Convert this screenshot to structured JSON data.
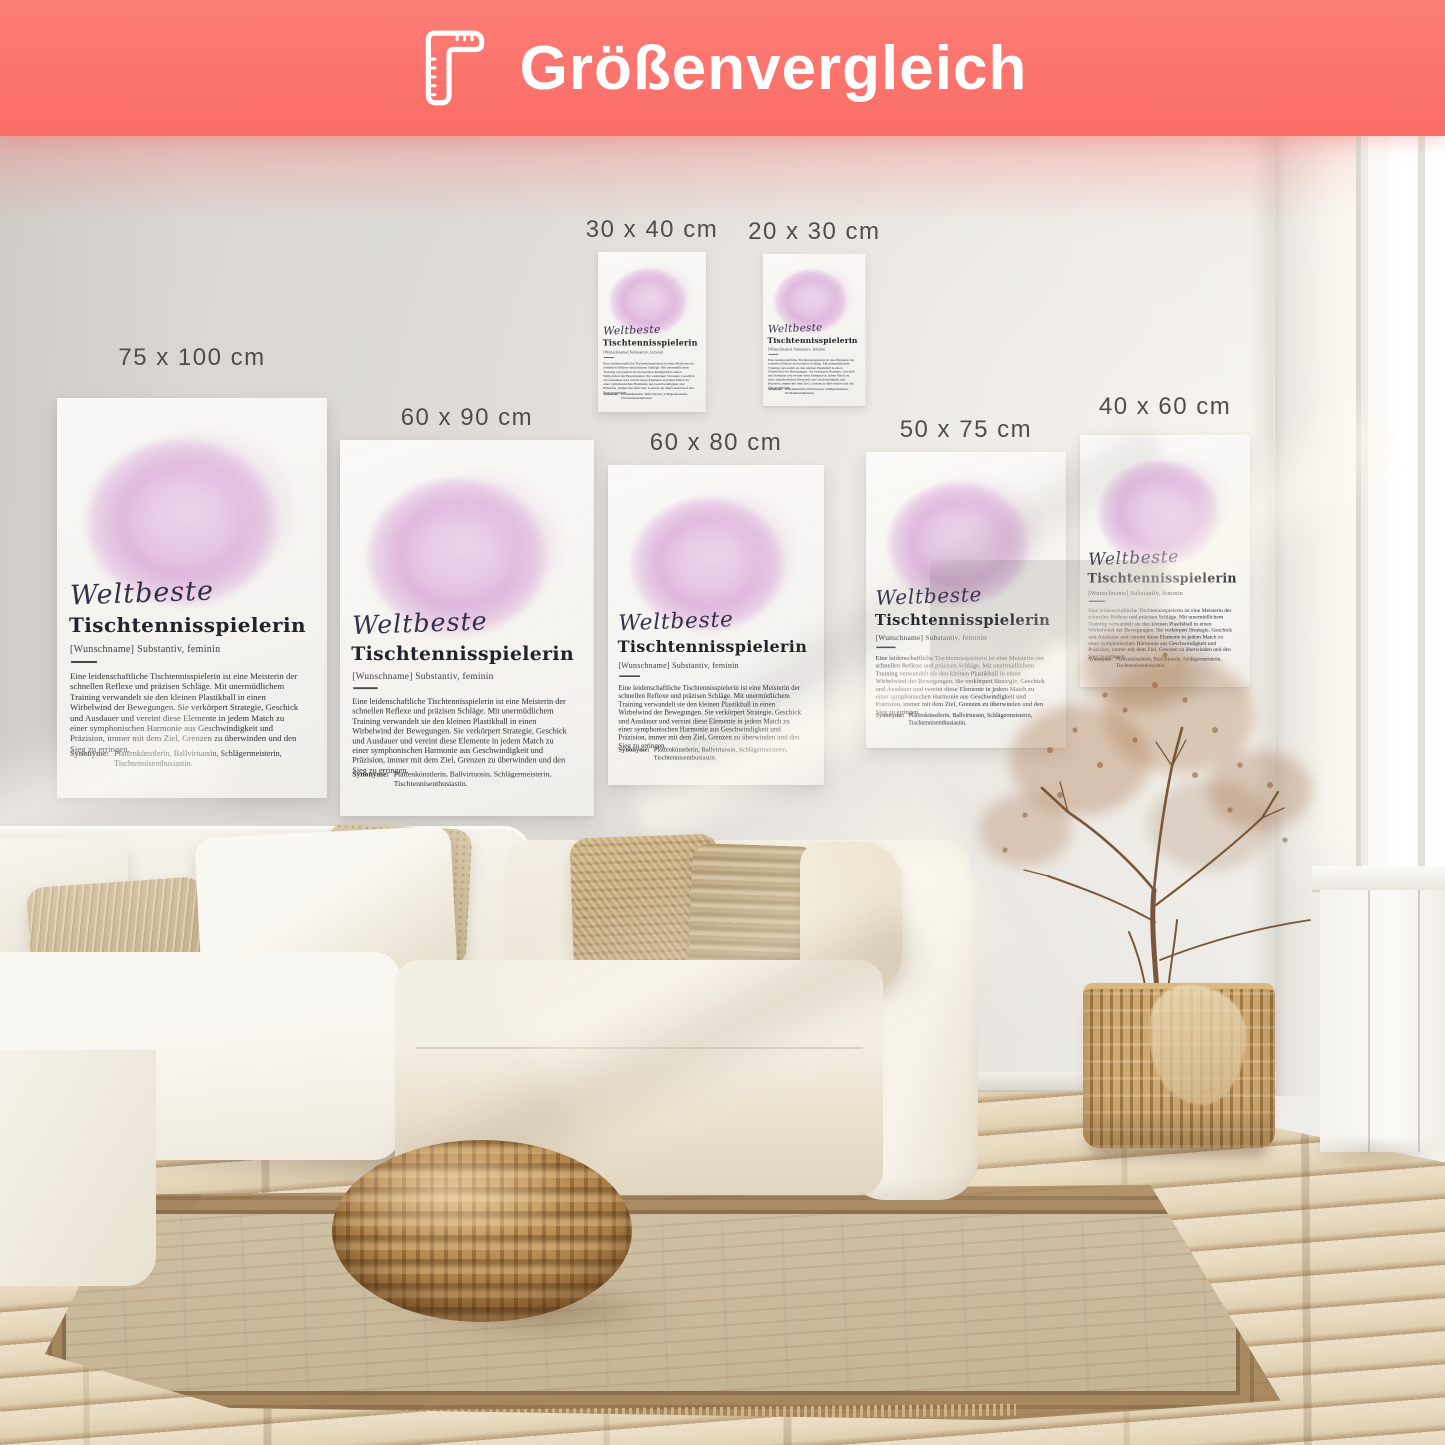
{
  "banner": {
    "title": "Größenvergleich",
    "icon": "ruler-icon",
    "background_color": "#fb716b",
    "text_color": "#ffffff"
  },
  "poster": {
    "script_word": "Weltbeste",
    "title": "Tischtennisspielerin",
    "subtitle": "[Wunschname] Substantiv, feminin",
    "body": "Eine leidenschaftliche Tischtennisspielerin ist eine Meisterin der schnellen Reflexe und präzisen Schläge. Mit unermüdlichem Training verwandelt sie den kleinen Plastikball in einen Wirbelwind der Bewegungen. Sie verkörpert Strategie, Geschick und Ausdauer und vereint diese Elemente in jedem Match zu einer symphonischen Harmonie aus Geschwindigkeit und Präzision, immer mit dem Ziel, Grenzen zu überwinden und den Sieg zu erringen.",
    "synonyms_label": "Synonyme:",
    "synonyms": "Plattenkünstlerin, Ballvirtuosin, Schlägermeisterin, Tischtennisenthusiastin.",
    "blob_color": "#dfb6dd"
  },
  "sizes": [
    {
      "label": "75 x 100 cm"
    },
    {
      "label": "60 x 90 cm"
    },
    {
      "label": "30 x 40 cm"
    },
    {
      "label": "20 x 30 cm"
    },
    {
      "label": "60 x 80 cm"
    },
    {
      "label": "50 x 75 cm"
    },
    {
      "label": "40 x 60 cm"
    }
  ]
}
